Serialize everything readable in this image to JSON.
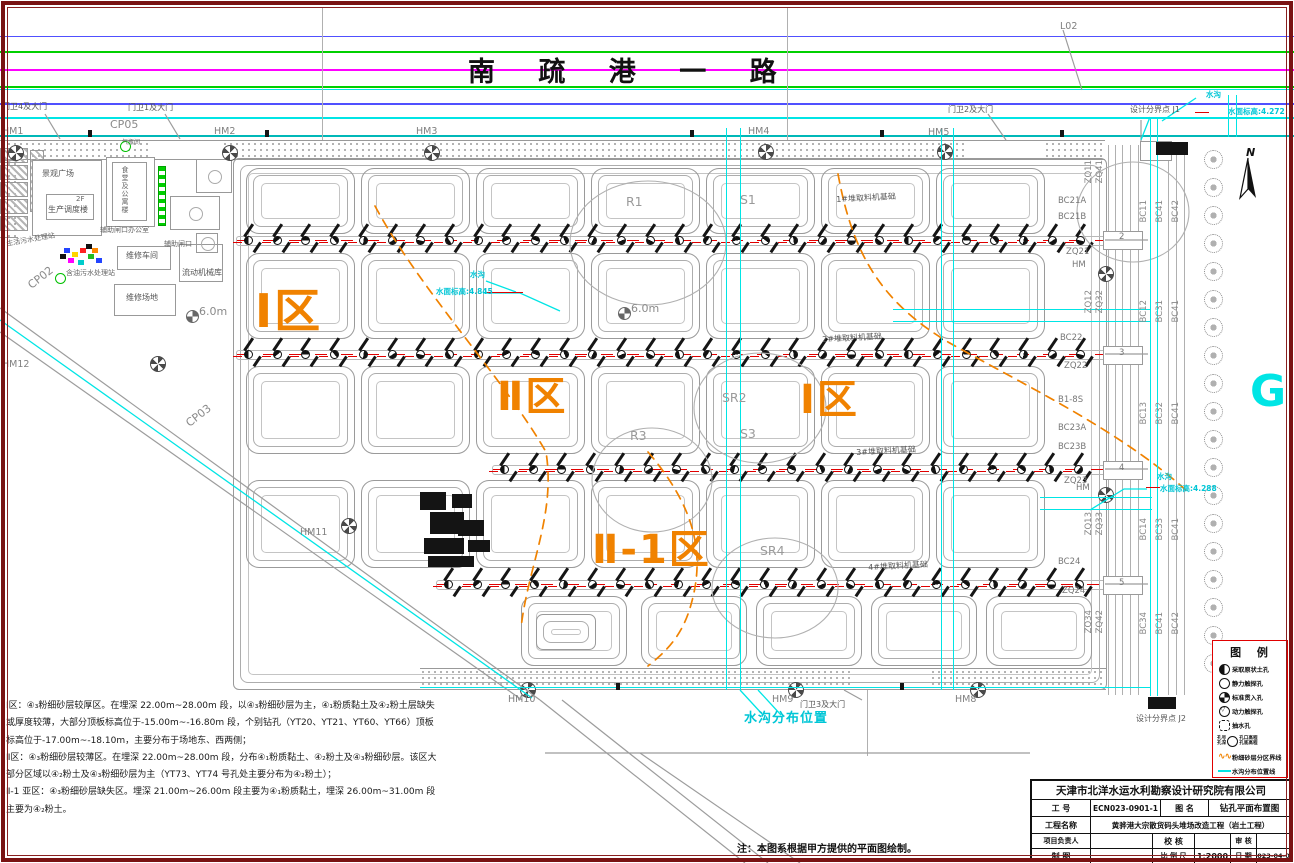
{
  "colors": {
    "accent_orange": "#f08200",
    "cyan": "#00e5e5",
    "red": "#e00000",
    "green": "#00c800",
    "magenta": "#ff00ff",
    "blue": "#5050ff",
    "frame_maroon": "#7a1212"
  },
  "road": {
    "title": "南 疏 港 一 路",
    "l02": "L02"
  },
  "legend": {
    "title": "图  例",
    "items": [
      {
        "sym": "half",
        "text": "采取原状土孔"
      },
      {
        "sym": "circle",
        "text": "静力触探孔"
      },
      {
        "sym": "grid",
        "text": "标准贯入孔"
      },
      {
        "sym": "tri",
        "text": "动力触探孔"
      },
      {
        "sym": "dash",
        "text": "抽水孔"
      },
      {
        "sym": "combo",
        "left": "孔号\n孔深",
        "right": "孔口高程\n孔底高程",
        "text": ""
      },
      {
        "sym": "wave",
        "text": "粉细砂层分区界线"
      },
      {
        "sym": "cyan",
        "text": "水沟分布位置线"
      }
    ]
  },
  "notes": {
    "p1": "Ⅰ区：④₃粉细砂层较厚区。在埋深 22.00m~28.00m 段，以④₃粉细砂层为主，④₁粉质黏土及④₂粉土层缺失或厚度较薄，大部分顶板标高位于-15.00m~-16.80m 段，个别钻孔（YT20、YT21、YT60、YT66）顶板标高位于-17.00m~-18.10m，主要分布于场地东、西两侧；",
    "p2": "Ⅱ区：④₃粉细砂层较薄区。在埋深 22.00m~28.00m 段，分布④₁粉质黏土、④₂粉土及④₃粉细砂层。该区大部分区域以④₂粉土及④₃粉细砂层为主（YT73、YT74 号孔处主要分布为④₂粉土）；",
    "p3": "Ⅱ-1 亚区：④₃粉细砂层缺失区。埋深 21.00m~26.00m 段主要为④₁粉质黏土，埋深 26.00m~31.00m 段主要为④₂粉土。",
    "bottom": "注：本图系根据甲方提供的平面图绘制。"
  },
  "titleblock": {
    "company": "天津市北洋水运水利勘察设计研究院有限公司",
    "job_label": "工  号",
    "job_value": "ECN023-0901-1",
    "drawing_label": "图  名",
    "drawing_value": "钻孔平面布置图",
    "project_label": "工程名称",
    "project_value": "黄骅港大宗散货码头堆场改造工程（岩土工程）",
    "pm_label": "项目负责人",
    "check_label": "校  核",
    "review_label": "审  核",
    "draft_label": "制  图",
    "scale_label": "比 例 尺",
    "scale_value": "1:2000",
    "date_label": "日  期",
    "date_value": "2023-04-05"
  },
  "plan": {
    "labels": [
      {
        "t": "L02",
        "x": 1060,
        "y": 22,
        "c": "lbl-g10"
      },
      {
        "t": "门卫4及大门",
        "x": 2,
        "y": 103,
        "c": "lbl-g8"
      },
      {
        "t": "门卫1及大门",
        "x": 128,
        "y": 104,
        "c": "lbl-g8"
      },
      {
        "t": "CP05",
        "x": 110,
        "y": 119,
        "c": "lbl-g11"
      },
      {
        "t": "HM1",
        "x": 2,
        "y": 127,
        "c": "lbl-g10"
      },
      {
        "t": "HM2",
        "x": 214,
        "y": 127,
        "c": "lbl-g10"
      },
      {
        "t": "HM3",
        "x": 416,
        "y": 127,
        "c": "lbl-g10"
      },
      {
        "t": "HM4",
        "x": 748,
        "y": 127,
        "c": "lbl-g10"
      },
      {
        "t": "HM5",
        "x": 928,
        "y": 128,
        "c": "lbl-g10"
      },
      {
        "t": "门卫2及大门",
        "x": 948,
        "y": 106,
        "c": "lbl-g8"
      },
      {
        "t": "设计分界点 J1",
        "x": 1130,
        "y": 106,
        "c": "lbl-g8"
      },
      {
        "t": "水沟",
        "x": 1206,
        "y": 91,
        "c": "lbl-cy"
      },
      {
        "t": "水面标高:4.272",
        "x": 1228,
        "y": 108,
        "c": "lbl-cy"
      },
      {
        "t": "气瓶间",
        "x": 122,
        "y": 140,
        "c": "lbl-g6"
      },
      {
        "t": "景观广场",
        "x": 42,
        "y": 170,
        "c": "lbl-g8"
      },
      {
        "t": "2F",
        "x": 76,
        "y": 196,
        "c": "lbl-g7"
      },
      {
        "t": "生产调度楼",
        "x": 48,
        "y": 206,
        "c": "lbl-g8"
      },
      {
        "t": "辅助闸口办公室",
        "x": 100,
        "y": 227,
        "c": "lbl-g7"
      },
      {
        "t": "辅助闸口",
        "x": 164,
        "y": 241,
        "c": "lbl-g7"
      },
      {
        "t": "生活污水处理站",
        "x": 6,
        "y": 241,
        "c": "lbl-g7",
        "r": -10
      },
      {
        "t": "含油污水处理站",
        "x": 66,
        "y": 270,
        "c": "lbl-g7"
      },
      {
        "t": "维修车间",
        "x": 126,
        "y": 252,
        "c": "lbl-g8"
      },
      {
        "t": "流动机械库",
        "x": 182,
        "y": 269,
        "c": "lbl-g8"
      },
      {
        "t": "维修场地",
        "x": 126,
        "y": 294,
        "c": "lbl-g8"
      },
      {
        "t": "CP02",
        "x": 26,
        "y": 282,
        "c": "lbl-g11",
        "r": -38
      },
      {
        "t": "CP03",
        "x": 184,
        "y": 420,
        "c": "lbl-g11",
        "r": -38
      },
      {
        "t": "HM12",
        "x": 2,
        "y": 360,
        "c": "lbl-g10"
      },
      {
        "t": "HM11",
        "x": 300,
        "y": 528,
        "c": "lbl-g10"
      },
      {
        "t": "Ⅰ区",
        "x": 255,
        "y": 288,
        "c": "lbl-zone",
        "fs": 46
      },
      {
        "t": "Ⅱ区",
        "x": 497,
        "y": 377,
        "c": "lbl-zone",
        "fs": 40
      },
      {
        "t": "Ⅰ区",
        "x": 800,
        "y": 380,
        "c": "lbl-zone",
        "fs": 40
      },
      {
        "t": "Ⅱ-1区",
        "x": 592,
        "y": 530,
        "c": "lbl-zone",
        "fs": 40
      },
      {
        "t": "R1",
        "x": 626,
        "y": 196,
        "c": "lbl-g12"
      },
      {
        "t": "S1",
        "x": 740,
        "y": 194,
        "c": "lbl-g12"
      },
      {
        "t": "SR2",
        "x": 722,
        "y": 392,
        "c": "lbl-g12"
      },
      {
        "t": "S3",
        "x": 740,
        "y": 428,
        "c": "lbl-g12"
      },
      {
        "t": "R3",
        "x": 630,
        "y": 430,
        "c": "lbl-g12"
      },
      {
        "t": "SR4",
        "x": 760,
        "y": 545,
        "c": "lbl-g12"
      },
      {
        "t": "1#堆取料机基础",
        "x": 836,
        "y": 196,
        "c": "lbl-g8",
        "r": -3
      },
      {
        "t": "2#堆取料机基础",
        "x": 822,
        "y": 336,
        "c": "lbl-g8",
        "r": -3
      },
      {
        "t": "3#堆取料机基础",
        "x": 856,
        "y": 449,
        "c": "lbl-g8",
        "r": -3
      },
      {
        "t": "4#堆取料机基础",
        "x": 868,
        "y": 564,
        "c": "lbl-g8",
        "r": -3
      },
      {
        "t": "水沟",
        "x": 470,
        "y": 271,
        "c": "lbl-cy"
      },
      {
        "t": "水面标高:4.845",
        "x": 436,
        "y": 288,
        "c": "lbl-cy"
      },
      {
        "t": "水沟",
        "x": 1157,
        "y": 473,
        "c": "lbl-cy"
      },
      {
        "t": "水面标高:4.288",
        "x": 1160,
        "y": 485,
        "c": "lbl-cy"
      },
      {
        "t": "HM10",
        "x": 508,
        "y": 695,
        "c": "lbl-g10"
      },
      {
        "t": "HM9",
        "x": 772,
        "y": 695,
        "c": "lbl-g10"
      },
      {
        "t": "门卫3及大门",
        "x": 800,
        "y": 701,
        "c": "lbl-g8"
      },
      {
        "t": "HM8",
        "x": 955,
        "y": 695,
        "c": "lbl-g10"
      },
      {
        "t": "水沟分布位置",
        "x": 744,
        "y": 712,
        "c": "lbl-cyb"
      },
      {
        "t": "设计分界点 J2",
        "x": 1136,
        "y": 715,
        "c": "lbl-g8"
      },
      {
        "t": "BC21A",
        "x": 1058,
        "y": 197,
        "c": "lbl-g9"
      },
      {
        "t": "BC21B",
        "x": 1058,
        "y": 213,
        "c": "lbl-g9"
      },
      {
        "t": "ZQ21",
        "x": 1066,
        "y": 248,
        "c": "lbl-g9"
      },
      {
        "t": "HM",
        "x": 1072,
        "y": 261,
        "c": "lbl-g9"
      },
      {
        "t": "BC22",
        "x": 1060,
        "y": 334,
        "c": "lbl-g9"
      },
      {
        "t": "ZQ22",
        "x": 1064,
        "y": 362,
        "c": "lbl-g9"
      },
      {
        "t": "B1-8S",
        "x": 1058,
        "y": 396,
        "c": "lbl-g9"
      },
      {
        "t": "BC23A",
        "x": 1058,
        "y": 424,
        "c": "lbl-g9"
      },
      {
        "t": "BC23B",
        "x": 1058,
        "y": 443,
        "c": "lbl-g9"
      },
      {
        "t": "ZQ23",
        "x": 1064,
        "y": 477,
        "c": "lbl-g9"
      },
      {
        "t": "HM",
        "x": 1076,
        "y": 484,
        "c": "lbl-g9"
      },
      {
        "t": "BC24",
        "x": 1058,
        "y": 558,
        "c": "lbl-g9"
      },
      {
        "t": "ZQ24",
        "x": 1062,
        "y": 587,
        "c": "lbl-g9"
      },
      {
        "t": "G",
        "x": 1250,
        "y": 370,
        "c": "lbl-G"
      },
      {
        "t": "6.0m",
        "x": 199,
        "y": 306,
        "c": "lbl-g11"
      },
      {
        "t": "6.0m",
        "x": 631,
        "y": 303,
        "c": "lbl-g11"
      },
      {
        "t": "2",
        "x": 1119,
        "y": 233,
        "c": "lbl-g9"
      },
      {
        "t": "3",
        "x": 1119,
        "y": 349,
        "c": "lbl-g9"
      },
      {
        "t": "4",
        "x": 1119,
        "y": 464,
        "c": "lbl-g9"
      },
      {
        "t": "5",
        "x": 1119,
        "y": 579,
        "c": "lbl-g9"
      }
    ],
    "vlabels": [
      {
        "t": "ZQ11",
        "x": 1085,
        "y": 160
      },
      {
        "t": "ZQ41",
        "x": 1096,
        "y": 160
      },
      {
        "t": "BC11",
        "x": 1140,
        "y": 200
      },
      {
        "t": "BC41",
        "x": 1156,
        "y": 200
      },
      {
        "t": "BC42",
        "x": 1172,
        "y": 200
      },
      {
        "t": "ZQ12",
        "x": 1085,
        "y": 290
      },
      {
        "t": "ZQ32",
        "x": 1096,
        "y": 290
      },
      {
        "t": "BC12",
        "x": 1140,
        "y": 300
      },
      {
        "t": "BC31",
        "x": 1156,
        "y": 300
      },
      {
        "t": "BC41",
        "x": 1172,
        "y": 300
      },
      {
        "t": "BC13",
        "x": 1140,
        "y": 402
      },
      {
        "t": "BC32",
        "x": 1156,
        "y": 402
      },
      {
        "t": "BC41",
        "x": 1172,
        "y": 402
      },
      {
        "t": "ZQ13",
        "x": 1085,
        "y": 512
      },
      {
        "t": "ZQ33",
        "x": 1096,
        "y": 512
      },
      {
        "t": "BC14",
        "x": 1140,
        "y": 518
      },
      {
        "t": "BC33",
        "x": 1156,
        "y": 518
      },
      {
        "t": "BC41",
        "x": 1172,
        "y": 518
      },
      {
        "t": "ZQ34",
        "x": 1085,
        "y": 610
      },
      {
        "t": "ZQ42",
        "x": 1096,
        "y": 610
      },
      {
        "t": "BC34",
        "x": 1140,
        "y": 612
      },
      {
        "t": "BC41",
        "x": 1156,
        "y": 612
      },
      {
        "t": "BC42",
        "x": 1172,
        "y": 612
      }
    ],
    "building_vertical_text": "食堂及公寓楼"
  },
  "gen": {
    "road_lines": [
      {
        "y": 36,
        "h": 1.4,
        "c": "#5050ff"
      },
      {
        "y": 51,
        "h": 2,
        "c": "#00d000"
      },
      {
        "y": 69,
        "h": 1.5,
        "c": "#ff00ff"
      },
      {
        "y": 86,
        "h": 2,
        "c": "#00d000"
      },
      {
        "y": 89,
        "h": 1,
        "c": "#00e5e5"
      },
      {
        "y": 103,
        "h": 1.5,
        "c": "#5050ff"
      },
      {
        "y": 117,
        "h": 1.5,
        "c": "#00e5e5"
      },
      {
        "y": 135,
        "h": 2,
        "c": "#00b8b8"
      }
    ],
    "yard": {
      "outer": [
        233,
        158,
        872,
        530
      ],
      "rows": [
        {
          "y": 168,
          "h": 64,
          "w": 107,
          "cols": [
            246,
            361,
            476,
            591,
            706,
            821,
            936
          ]
        },
        {
          "y": 253,
          "h": 84,
          "w": 107,
          "cols": [
            246,
            361,
            476,
            591,
            706,
            821,
            936
          ]
        },
        {
          "y": 366,
          "h": 86,
          "w": 107,
          "cols": [
            246,
            361,
            476,
            591,
            706,
            821,
            936
          ]
        },
        {
          "y": 480,
          "h": 86,
          "w": 107,
          "cols": [
            246,
            361,
            476,
            591,
            706,
            821,
            936
          ]
        },
        {
          "y": 596,
          "h": 68,
          "w": 104,
          "cols": [
            521,
            641,
            756,
            871,
            986
          ]
        }
      ],
      "small": [
        [
          536,
          614,
          58,
          34
        ]
      ]
    },
    "drill_rows": [
      {
        "y": 240,
        "x0": 246,
        "n": 30,
        "dx": 28.7
      },
      {
        "y": 354,
        "x0": 246,
        "n": 30,
        "dx": 28.7
      },
      {
        "y": 469,
        "x0": 502,
        "n": 21,
        "dx": 28.7
      },
      {
        "y": 584,
        "x0": 446,
        "n": 23,
        "dx": 28.7
      }
    ],
    "trees": {
      "x": 1204,
      "y0": 150,
      "n": 19,
      "dy": 28
    },
    "wheels": [
      [
        8,
        145
      ],
      [
        222,
        145
      ],
      [
        424,
        145
      ],
      [
        758,
        144
      ],
      [
        937,
        144
      ],
      [
        150,
        356
      ],
      [
        341,
        518
      ],
      [
        520,
        682
      ],
      [
        788,
        682
      ],
      [
        970,
        682
      ],
      [
        1098,
        266
      ],
      [
        1098,
        487
      ]
    ],
    "benchmarks": [
      [
        186,
        310
      ],
      [
        618,
        307
      ]
    ],
    "grayverts": [
      [
        1108,
        145,
        550
      ],
      [
        1115,
        145,
        550
      ],
      [
        1122,
        145,
        550
      ],
      [
        1130,
        145,
        550
      ],
      [
        1138,
        145,
        550
      ],
      [
        1168,
        145,
        550
      ],
      [
        1176,
        145,
        550
      ],
      [
        1184,
        145,
        550
      ],
      [
        322,
        8,
        132
      ],
      [
        787,
        8,
        132
      ],
      [
        867,
        690,
        66
      ]
    ],
    "ghouses": [
      [
        1103,
        231,
        38,
        17
      ],
      [
        1103,
        346,
        38,
        17
      ],
      [
        1103,
        461,
        38,
        17
      ],
      [
        1103,
        576,
        38,
        17
      ],
      [
        1140,
        141,
        30,
        18
      ]
    ],
    "cyan": [
      [
        726,
        128,
        1.4,
        562
      ],
      [
        740,
        128,
        1.4,
        562
      ],
      [
        941,
        128,
        1.4,
        562
      ],
      [
        953,
        128,
        1.4,
        562
      ],
      [
        1150,
        118,
        1.4,
        578
      ],
      [
        1157,
        118,
        1.4,
        578
      ],
      [
        893,
        309,
        258,
        1.4
      ],
      [
        893,
        321,
        258,
        1.4
      ],
      [
        1040,
        497,
        112,
        1.4
      ],
      [
        1040,
        509,
        112,
        1.4
      ],
      [
        420,
        687,
        731,
        1.4
      ],
      [
        1228,
        95,
        1.4,
        42
      ],
      [
        1236,
        95,
        1.4,
        42
      ]
    ],
    "red": [
      [
        485,
        292,
        38,
        1.4
      ],
      [
        1146,
        487,
        14,
        1.4
      ],
      [
        1195,
        112,
        14,
        1.4
      ]
    ],
    "dots": [
      [
        88,
        130,
        4,
        7
      ],
      [
        265,
        130,
        4,
        7
      ],
      [
        690,
        130,
        4,
        7
      ],
      [
        880,
        130,
        4,
        7
      ],
      [
        1060,
        130,
        4,
        7
      ],
      [
        616,
        683,
        4,
        7
      ],
      [
        900,
        683,
        4,
        7
      ]
    ],
    "blackblocks": [
      [
        1156,
        142,
        32,
        13
      ],
      [
        1148,
        697,
        28,
        12
      ],
      [
        428,
        556,
        46,
        11
      ],
      [
        420,
        492,
        26,
        18
      ],
      [
        430,
        512,
        34,
        22
      ],
      [
        452,
        494,
        20,
        14
      ],
      [
        424,
        538,
        40,
        16
      ],
      [
        458,
        520,
        26,
        16
      ],
      [
        468,
        540,
        22,
        12
      ]
    ],
    "hatches": [
      [
        0,
        148,
        26,
        13
      ],
      [
        0,
        165,
        26,
        13
      ],
      [
        0,
        182,
        26,
        13
      ],
      [
        0,
        199,
        26,
        13
      ],
      [
        0,
        216,
        26,
        13
      ],
      [
        30,
        150,
        12,
        60
      ]
    ],
    "bands": [
      [
        0,
        140,
        1105,
        18
      ],
      [
        420,
        668,
        686,
        20
      ],
      [
        0,
        160,
        18,
        76
      ]
    ],
    "gaps": [
      [
        148,
        141,
        72,
        17
      ],
      [
        966,
        141,
        76,
        17
      ],
      [
        852,
        669,
        76,
        18
      ]
    ],
    "boxes": [
      [
        32,
        160,
        68,
        74
      ],
      [
        46,
        194,
        46,
        24
      ],
      [
        106,
        157,
        47,
        68
      ],
      [
        112,
        162,
        33,
        57
      ],
      [
        117,
        246,
        52,
        22
      ],
      [
        179,
        244,
        42,
        36
      ],
      [
        114,
        284,
        60,
        30
      ]
    ],
    "courts": [
      [
        196,
        159,
        34,
        32
      ],
      [
        170,
        196,
        48,
        32
      ],
      [
        196,
        233,
        20,
        18
      ]
    ],
    "equipbits": [
      [
        64,
        248,
        "#2244ff"
      ],
      [
        72,
        252,
        "#ffd400"
      ],
      [
        80,
        248,
        "#ff2222"
      ],
      [
        88,
        254,
        "#22bb22"
      ],
      [
        68,
        258,
        "#ff00ff"
      ],
      [
        78,
        260,
        "#00cccc"
      ],
      [
        92,
        248,
        "#ff8800"
      ],
      [
        96,
        258,
        "#2244ff"
      ],
      [
        86,
        244,
        "#111111"
      ],
      [
        60,
        254,
        "#111111"
      ]
    ],
    "gbar": [
      158,
      166,
      6,
      58
    ],
    "gcircs": [
      [
        120,
        141
      ],
      [
        55,
        273
      ]
    ]
  }
}
